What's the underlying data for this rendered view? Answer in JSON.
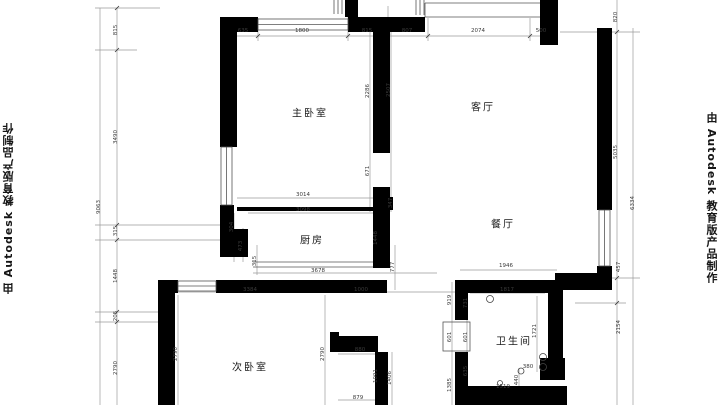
{
  "watermarks": {
    "left": "由 Autodesk 教育版产品制作",
    "right": "由 Autodesk 教育版产品制作"
  },
  "rooms": [
    {
      "name": "master-bedroom",
      "label": "主卧室",
      "x": 310,
      "y": 112
    },
    {
      "name": "living-room",
      "label": "客厅",
      "x": 483,
      "y": 106
    },
    {
      "name": "dining-room",
      "label": "餐厅",
      "x": 503,
      "y": 223
    },
    {
      "name": "kitchen",
      "label": "厨房",
      "x": 312,
      "y": 239
    },
    {
      "name": "second-bedroom",
      "label": "次卧室",
      "x": 250,
      "y": 366
    },
    {
      "name": "bathroom",
      "label": "卫生间",
      "x": 514,
      "y": 340
    }
  ],
  "dimensions": [
    {
      "text": "635",
      "x": 243,
      "y": 31,
      "rot": "h"
    },
    {
      "text": "1800",
      "x": 302,
      "y": 31,
      "rot": "h"
    },
    {
      "text": "815",
      "x": 367,
      "y": 31,
      "rot": "h"
    },
    {
      "text": "807",
      "x": 407,
      "y": 31,
      "rot": "h"
    },
    {
      "text": "2074",
      "x": 478,
      "y": 31,
      "rot": "h"
    },
    {
      "text": "500",
      "x": 541,
      "y": 31,
      "rot": "h"
    },
    {
      "text": "815",
      "x": 116,
      "y": 30,
      "rot": "v"
    },
    {
      "text": "3490",
      "x": 116,
      "y": 137,
      "rot": "v"
    },
    {
      "text": "315",
      "x": 116,
      "y": 231,
      "rot": "v"
    },
    {
      "text": "1448",
      "x": 116,
      "y": 276,
      "rot": "v"
    },
    {
      "text": "205",
      "x": 116,
      "y": 316,
      "rot": "v"
    },
    {
      "text": "2790",
      "x": 116,
      "y": 368,
      "rot": "v"
    },
    {
      "text": "9063",
      "x": 99,
      "y": 207,
      "rot": "v"
    },
    {
      "text": "820",
      "x": 616,
      "y": 17,
      "rot": "v"
    },
    {
      "text": "5035",
      "x": 616,
      "y": 152,
      "rot": "v"
    },
    {
      "text": "457",
      "x": 619,
      "y": 267,
      "rot": "v"
    },
    {
      "text": "2154",
      "x": 619,
      "y": 327,
      "rot": "v"
    },
    {
      "text": "6334",
      "x": 633,
      "y": 203,
      "rot": "v"
    },
    {
      "text": "2286",
      "x": 368,
      "y": 91,
      "rot": "v"
    },
    {
      "text": "2507",
      "x": 389,
      "y": 90,
      "rot": "v"
    },
    {
      "text": "671",
      "x": 368,
      "y": 171,
      "rot": "v"
    },
    {
      "text": "3014",
      "x": 303,
      "y": 195,
      "rot": "h"
    },
    {
      "text": "3098",
      "x": 303,
      "y": 210,
      "rot": "h"
    },
    {
      "text": "347",
      "x": 391,
      "y": 203,
      "rot": "v"
    },
    {
      "text": "304",
      "x": 232,
      "y": 227,
      "rot": "v"
    },
    {
      "text": "473",
      "x": 241,
      "y": 246,
      "rot": "v"
    },
    {
      "text": "315",
      "x": 255,
      "y": 261,
      "rot": "v"
    },
    {
      "text": "1448",
      "x": 376,
      "y": 238,
      "rot": "v"
    },
    {
      "text": "777",
      "x": 393,
      "y": 267,
      "rot": "v"
    },
    {
      "text": "3678",
      "x": 318,
      "y": 271,
      "rot": "h"
    },
    {
      "text": "3384",
      "x": 250,
      "y": 290,
      "rot": "h"
    },
    {
      "text": "1000",
      "x": 361,
      "y": 290,
      "rot": "h"
    },
    {
      "text": "2790",
      "x": 176,
      "y": 354,
      "rot": "v"
    },
    {
      "text": "2790",
      "x": 323,
      "y": 354,
      "rot": "v"
    },
    {
      "text": "880",
      "x": 360,
      "y": 350,
      "rot": "h"
    },
    {
      "text": "1091",
      "x": 376,
      "y": 376,
      "rot": "v"
    },
    {
      "text": "1406",
      "x": 390,
      "y": 378,
      "rot": "v"
    },
    {
      "text": "879",
      "x": 358,
      "y": 398,
      "rot": "h"
    },
    {
      "text": "919",
      "x": 450,
      "y": 300,
      "rot": "v"
    },
    {
      "text": "731",
      "x": 466,
      "y": 303,
      "rot": "v"
    },
    {
      "text": "601",
      "x": 450,
      "y": 337,
      "rot": "v"
    },
    {
      "text": "601",
      "x": 466,
      "y": 337,
      "rot": "v"
    },
    {
      "text": "635",
      "x": 466,
      "y": 371,
      "rot": "v"
    },
    {
      "text": "1385",
      "x": 450,
      "y": 385,
      "rot": "v"
    },
    {
      "text": "1946",
      "x": 506,
      "y": 266,
      "rot": "h"
    },
    {
      "text": "1817",
      "x": 507,
      "y": 290,
      "rot": "h"
    },
    {
      "text": "1721",
      "x": 535,
      "y": 331,
      "rot": "v"
    },
    {
      "text": "380",
      "x": 528,
      "y": 367,
      "rot": "h"
    },
    {
      "text": "440",
      "x": 517,
      "y": 380,
      "rot": "v"
    },
    {
      "text": "1519",
      "x": 503,
      "y": 387,
      "rot": "h"
    }
  ]
}
